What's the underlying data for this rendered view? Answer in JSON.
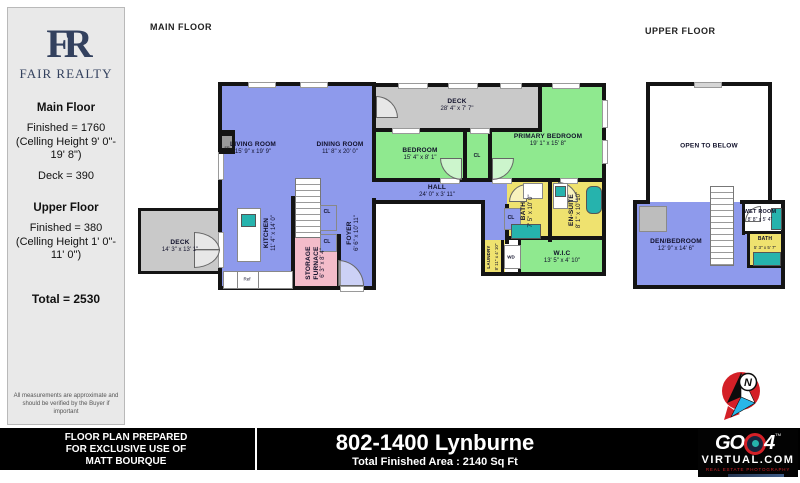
{
  "headers": {
    "main_floor": "MAIN FLOOR",
    "upper_floor": "UPPER FLOOR"
  },
  "sidebar": {
    "brand_monogram": "FR",
    "brand_name": "FAIR REALTY",
    "main_title": "Main Floor",
    "main_finished": "Finished  =  1760",
    "main_ceiling": "(Celling Height 9' 0\"-\n19' 8\")",
    "deck_line": "Deck = 390",
    "upper_title": "Upper Floor",
    "upper_finished": "Finished  =  380",
    "upper_ceiling": "(Celling Height 1' 0\"-\n11' 0\")",
    "total": "Total = 2530",
    "disclaimer": "All measurements are approximate and\nshould be verified by the Buyer if important"
  },
  "main_floor": {
    "rooms": {
      "living": {
        "name": "LIVING ROOM",
        "dims": "15' 9\" x 19' 9\""
      },
      "dining": {
        "name": "DINING ROOM",
        "dims": "11' 8\" x 20' 0\""
      },
      "deck_top": {
        "name": "DECK",
        "dims": "28' 4\" x 7' 7\""
      },
      "bedroom": {
        "name": "BEDROOM",
        "dims": "15' 4\" x 8' 1\""
      },
      "primary": {
        "name": "PRIMARY BEDROOM",
        "dims": "19' 1\" x 15' 8\""
      },
      "hall": {
        "name": "HALL",
        "dims": "24' 0\" x 3' 11\""
      },
      "bath": {
        "name": "BATH",
        "dims": "7' 5\" x 10' 0\""
      },
      "ensuite": {
        "name": "EN-SUITE",
        "dims": "8' 1\" x 10' 10\""
      },
      "wic": {
        "name": "W.I.C",
        "dims": "13' 5\" x 4' 10\""
      },
      "laundry": {
        "name": "LAUNDRY",
        "dims": "8' 11\" x 4' 10\""
      },
      "kitchen": {
        "name": "KITCHEN",
        "dims": "11' 4\" x 14' 0\""
      },
      "foyer": {
        "name": "FOYER",
        "dims": "6' 6\" x 10' 11\""
      },
      "storage": {
        "name": "STORAGE\nFURNACE",
        "dims": "6' 3\" x 8' 4\""
      },
      "deck_left": {
        "name": "DECK",
        "dims": "14' 3\" x 13' 1\""
      }
    },
    "labels": {
      "cl": "CL",
      "wd": "WD",
      "ref": "Ref",
      "fp": "FP"
    }
  },
  "upper_floor": {
    "open_below": "OPEN TO BELOW",
    "den": {
      "name": "DEN/BEDROOM",
      "dims": "12' 9\" x 14' 6\""
    },
    "wet": {
      "name": "WET ROOM",
      "dims": "8' 8\" x 5' 4\""
    },
    "bath": {
      "name": "BATH",
      "dims": "5' 3\" x 5' 7\""
    }
  },
  "compass": {
    "letter": "N"
  },
  "footer": {
    "prepared": "FLOOR PLAN PREPARED\nFOR EXCLUSIVE USE OF\nMATT BOURQUE",
    "address": "802-1400 Lynburne",
    "total_area": "Total Finished Area : 2140 Sq Ft",
    "logo": {
      "go": "GO",
      "four": "4",
      "tm": "TM",
      "site": "VIRTUAL.COM",
      "tagline": "REAL ESTATE PHOTOGRAPHY"
    }
  },
  "colors": {
    "floor_blue": "#8e9aec",
    "room_green": "#8fe98f",
    "wet_yellow": "#efe26f",
    "storage_pink": "#f3bcca",
    "deck_grey": "#c9c9c9",
    "wall_black": "#141414",
    "brand_navy": "#33415e",
    "logo_red": "#d42027",
    "logo_teal": "#26b3ad"
  }
}
